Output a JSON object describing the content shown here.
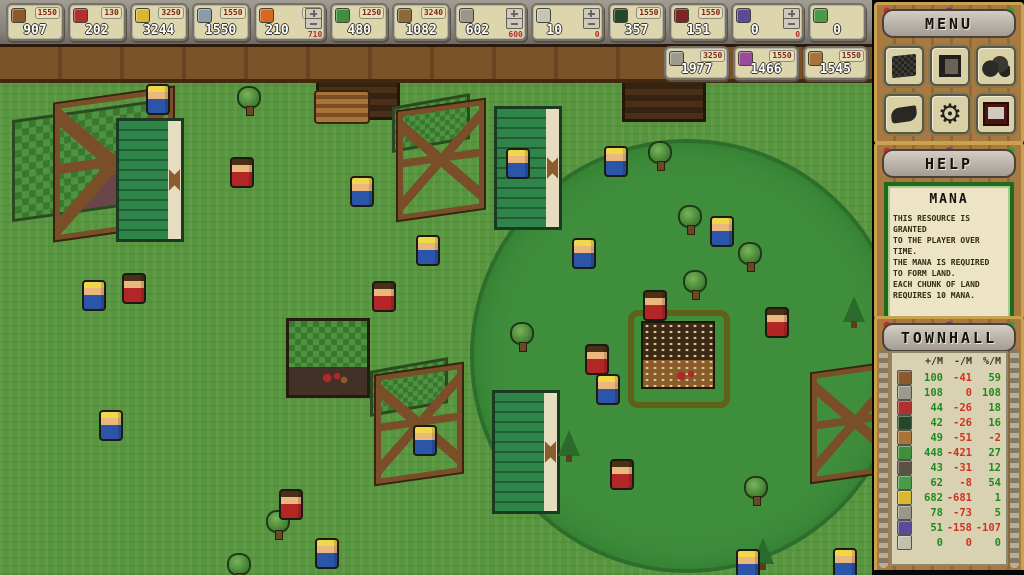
{
  "top_bar": {
    "row1": [
      {
        "icon": "wood",
        "value": "907",
        "cap": "1550"
      },
      {
        "icon": "meat",
        "value": "202",
        "cap": "130"
      },
      {
        "icon": "gold",
        "value": "3244",
        "cap": "3250"
      },
      {
        "icon": "tools",
        "value": "1550",
        "cap": "1550"
      },
      {
        "icon": "fire",
        "value": "210",
        "cap": "420",
        "stepper": "710"
      },
      {
        "icon": "herbs",
        "value": "480",
        "cap": "1250"
      },
      {
        "icon": "fence",
        "value": "1082",
        "cap": "3240"
      },
      {
        "icon": "bricks",
        "value": "602",
        "stepper": "600"
      },
      {
        "icon": "paper",
        "value": "10",
        "stepper": "0"
      },
      {
        "icon": "pine",
        "value": "357",
        "cap": "1550"
      },
      {
        "icon": "berries",
        "value": "151",
        "cap": "1550"
      },
      {
        "icon": "grapes",
        "value": "0",
        "stepper": "0"
      },
      {
        "icon": "cabbage",
        "value": "0"
      }
    ],
    "row2": [
      {
        "icon": "stone",
        "value": "1977",
        "cap": "3250"
      },
      {
        "icon": "amethyst",
        "value": "1466",
        "cap": "1550"
      },
      {
        "icon": "leather",
        "value": "1545",
        "cap": "1550"
      }
    ]
  },
  "icon_colors": {
    "wood": "#8a5a2e",
    "meat": "#b03030",
    "gold": "#d8b830",
    "tools": "#8a9aa8",
    "fire": "#d86820",
    "herbs": "#3f8f3f",
    "fence": "#8a6a3a",
    "bricks": "#9a968a",
    "paper": "#c8c4b4",
    "pine": "#26482a",
    "berries": "#7a2424",
    "grapes": "#5a4a9a",
    "cabbage": "#4a9a4a",
    "stone": "#9a9a8e",
    "amethyst": "#9a4a9a",
    "leather": "#a8743c",
    "wall": "#5a5248",
    "blank": "#c4c0b0"
  },
  "menu": {
    "title": "MENU",
    "gear_glyph": "⚙"
  },
  "help": {
    "title": "HELP",
    "topic": "MANA",
    "lines": [
      "THIS RESOURCE IS GRANTED",
      "TO THE PLAYER OVER TIME.",
      "THE MANA IS REQUIRED",
      "TO FORM LAND.",
      "EACH CHUNK OF LAND",
      "REQUIRES 10 MANA."
    ]
  },
  "townhall": {
    "title": "TOWNHALL",
    "columns": [
      "+/M",
      "-/M",
      "%/M"
    ],
    "rows": [
      {
        "icon": "wood",
        "gain": "100",
        "loss": "-41",
        "pct": "59"
      },
      {
        "icon": "stone",
        "gain": "108",
        "loss": "0",
        "pct": "108"
      },
      {
        "icon": "meat",
        "gain": "44",
        "loss": "-26",
        "pct": "18"
      },
      {
        "icon": "pine",
        "gain": "42",
        "loss": "-26",
        "pct": "16"
      },
      {
        "icon": "leather",
        "gain": "49",
        "loss": "-51",
        "pct": "-2"
      },
      {
        "icon": "herbs",
        "gain": "448",
        "loss": "-421",
        "pct": "27"
      },
      {
        "icon": "wall",
        "gain": "43",
        "loss": "-31",
        "pct": "12"
      },
      {
        "icon": "cabbage",
        "gain": "62",
        "loss": "-8",
        "pct": "54"
      },
      {
        "icon": "gold",
        "gain": "682",
        "loss": "-681",
        "pct": "1"
      },
      {
        "icon": "bricks",
        "gain": "78",
        "loss": "-73",
        "pct": "5"
      },
      {
        "icon": "grapes",
        "gain": "51",
        "loss": "-158",
        "pct": "-107"
      },
      {
        "icon": "blank",
        "gain": "0",
        "loss": "0",
        "pct": "0"
      }
    ]
  },
  "map": {
    "circle": {
      "cx": 683,
      "cy": 272,
      "r": 213
    },
    "entities": [
      {
        "t": "green-roof",
        "x": 12,
        "y": 30
      },
      {
        "t": "frame",
        "x": 55,
        "y": 16
      },
      {
        "t": "green-panel",
        "x": 116,
        "y": 38
      },
      {
        "t": "dark-lodge",
        "x": 316,
        "y": -12
      },
      {
        "t": "log-pile",
        "x": 314,
        "y": 10
      },
      {
        "t": "roof-piece",
        "x": 392,
        "y": 20
      },
      {
        "t": "frame-sm",
        "x": 398,
        "y": 26
      },
      {
        "t": "green-panel",
        "x": 494,
        "y": 26
      },
      {
        "t": "dark-lodge",
        "x": 622,
        "y": -10
      },
      {
        "t": "green-roof-house",
        "x": 286,
        "y": 238
      },
      {
        "t": "red-tools",
        "x": 322,
        "y": 290
      },
      {
        "t": "roof-piece",
        "x": 370,
        "y": 284
      },
      {
        "t": "frame-sm",
        "x": 376,
        "y": 290
      },
      {
        "t": "green-panel",
        "x": 492,
        "y": 310
      },
      {
        "t": "frame-sm",
        "x": 812,
        "y": 288
      },
      {
        "t": "townhall-sq",
        "x": 628,
        "y": 230
      },
      {
        "t": "red-tools",
        "x": 676,
        "y": 288
      },
      {
        "t": "tree",
        "x": 237,
        "y": 6
      },
      {
        "t": "tree",
        "x": 648,
        "y": 61
      },
      {
        "t": "tree",
        "x": 678,
        "y": 125
      },
      {
        "t": "tree",
        "x": 738,
        "y": 162
      },
      {
        "t": "tree",
        "x": 683,
        "y": 190
      },
      {
        "t": "tree",
        "x": 510,
        "y": 242
      },
      {
        "t": "tree",
        "x": 266,
        "y": 430
      },
      {
        "t": "tree",
        "x": 227,
        "y": 473
      },
      {
        "t": "tree",
        "x": 744,
        "y": 396
      },
      {
        "t": "pine",
        "x": 558,
        "y": 350
      },
      {
        "t": "pine",
        "x": 843,
        "y": 216
      },
      {
        "t": "pine",
        "x": 752,
        "y": 458
      },
      {
        "t": "villager-blue",
        "x": 146,
        "y": 4
      },
      {
        "t": "villager-blue",
        "x": 350,
        "y": 96
      },
      {
        "t": "villager-blue",
        "x": 506,
        "y": 68
      },
      {
        "t": "villager-blue",
        "x": 604,
        "y": 66
      },
      {
        "t": "villager-blue",
        "x": 416,
        "y": 155
      },
      {
        "t": "villager-blue",
        "x": 572,
        "y": 158
      },
      {
        "t": "villager-blue",
        "x": 710,
        "y": 136
      },
      {
        "t": "villager-blue",
        "x": 82,
        "y": 200
      },
      {
        "t": "villager-blue",
        "x": 596,
        "y": 294
      },
      {
        "t": "villager-blue",
        "x": 99,
        "y": 330
      },
      {
        "t": "villager-blue",
        "x": 413,
        "y": 345
      },
      {
        "t": "villager-blue",
        "x": 315,
        "y": 458
      },
      {
        "t": "villager-blue",
        "x": 736,
        "y": 469
      },
      {
        "t": "villager-blue",
        "x": 833,
        "y": 468
      },
      {
        "t": "villager-red",
        "x": 230,
        "y": 77
      },
      {
        "t": "villager-red",
        "x": 122,
        "y": 193
      },
      {
        "t": "villager-red",
        "x": 372,
        "y": 201
      },
      {
        "t": "villager-red",
        "x": 643,
        "y": 210
      },
      {
        "t": "villager-red",
        "x": 765,
        "y": 227
      },
      {
        "t": "villager-red",
        "x": 585,
        "y": 264
      },
      {
        "t": "villager-red",
        "x": 610,
        "y": 379
      },
      {
        "t": "villager-red",
        "x": 279,
        "y": 409
      }
    ]
  }
}
